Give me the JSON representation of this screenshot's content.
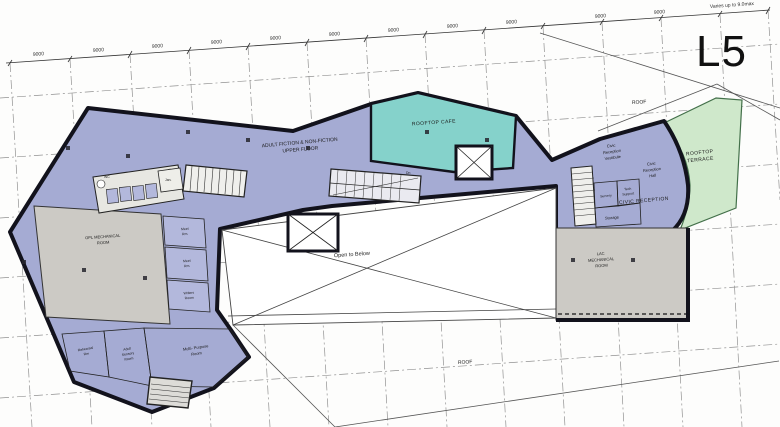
{
  "sheet": {
    "level": "L5",
    "note": "Varies up to 9.0max",
    "dims": [
      "9000",
      "9000",
      "9000",
      "9000",
      "9000",
      "9000",
      "9000",
      "9000",
      "9000",
      "9000",
      "9000"
    ],
    "labels": {
      "adult_fiction_1": "ADULT FICTION & NON-FICTION",
      "adult_fiction_2": "UPPER FLOOR",
      "rooftop_cafe": "ROOFTOP CAFE",
      "rooftop_terrace_1": "ROOFTOP",
      "rooftop_terrace_2": "TERRACE",
      "open_to_below": "Open to Below",
      "roof_upper": "ROOF",
      "roof_lower": "ROOF",
      "opl_mech_1": "OPL MECHANICAL",
      "opl_mech_2": "ROOM",
      "lac_mech_1": "LAC",
      "lac_mech_2": "MECHANICAL",
      "lac_mech_3": "ROOM",
      "civic_vest_1": "Civic",
      "civic_vest_2": "Reception",
      "civic_vest_3": "Vestibule",
      "civic_hall_1": "Civic",
      "civic_hall_2": "Reception",
      "civic_hall_3": "Hall",
      "civic_reception": "CIVIC RECEPTION",
      "servery": "Servery",
      "tech_1": "Tech",
      "tech_2": "Support",
      "storage": "Storage",
      "meet_1a": "Meet",
      "meet_1b": "Rm.",
      "meet_2a": "Meet",
      "meet_2b": "Rm.",
      "writers_1": "Writers",
      "writers_2": "Room",
      "multi_1": "Multi- Purpose",
      "multi_2": "Room",
      "rehearsal_1": "Rehearsal",
      "rehearsal_2": "Rm",
      "sensory_1": "Adult",
      "sensory_2": "Sensory",
      "sensory_3": "Room",
      "jan": "Jan.",
      "wc": "WC",
      "dn": "Dn"
    },
    "colors": {
      "floor_blue": "#a5abd3",
      "room_blue": "#b3b8dc",
      "cafe_teal": "#85d2cb",
      "terrace_green": "#cfe8cb",
      "mech_grey": "#cccac5",
      "fixture_grey": "#e7e7e2",
      "outline": "#12121c"
    }
  }
}
